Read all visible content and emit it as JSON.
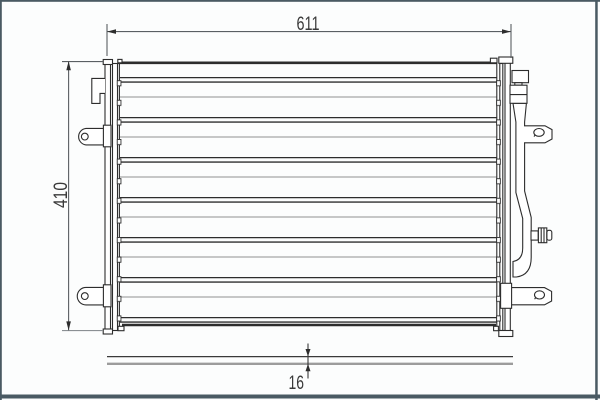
{
  "dimensions": {
    "width": "611",
    "height": "410",
    "depth": "16"
  },
  "colors": {
    "outline": "#2d2d2d",
    "fin_line": "#a6a6a6",
    "dimension_line": "#5a5f63",
    "label_text": "#3a3a3a",
    "frame_border": "#4a5a63",
    "background": "#fcfdfd"
  }
}
